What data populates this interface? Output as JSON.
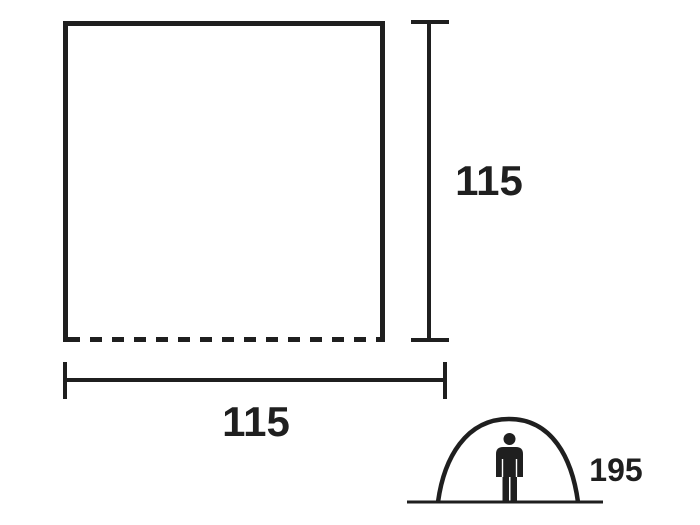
{
  "diagram": {
    "type": "product-dimension-drawing",
    "subject": "tent floor plan and standing height",
    "colors": {
      "line": "#1f1f1f",
      "background": "#ffffff"
    },
    "dimensions": {
      "floor_depth": "115",
      "floor_width": "115",
      "tent_height": "195"
    },
    "icons": [
      "tent-arch-icon",
      "person-icon"
    ],
    "notes": "square outline with dashed front (bottom) edge; vertical and horizontal dimension lines with end ticks; dome tent silhouette with standing person"
  }
}
